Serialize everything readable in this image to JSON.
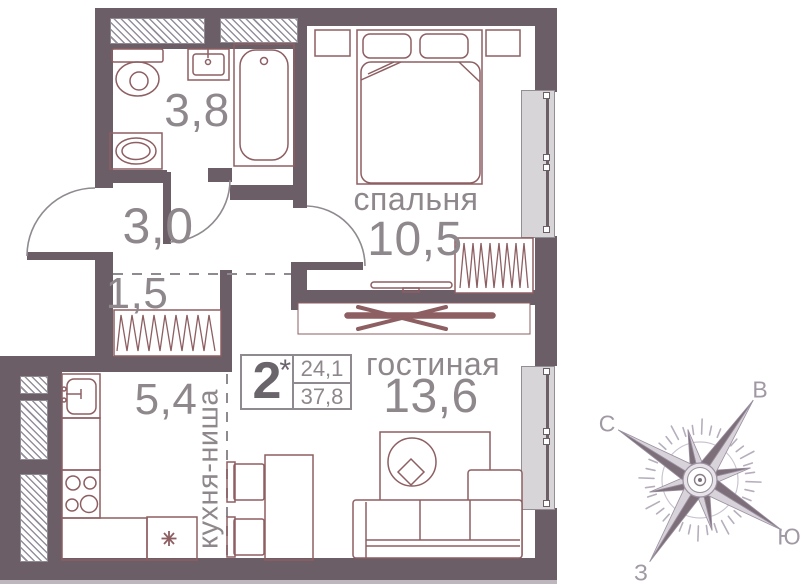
{
  "plan_type": "apartment-floor-plan",
  "rooms": {
    "bedroom": {
      "name": "спальня",
      "area": "10,5"
    },
    "living": {
      "name": "гостиная",
      "area": "13,6"
    },
    "kitchen": {
      "name": "кухня-ниша",
      "area": "5,4"
    },
    "bathroom": {
      "area": "3,8"
    },
    "hall": {
      "area": "3,0"
    },
    "closet": {
      "area": "1,5"
    }
  },
  "info": {
    "rooms_count": "2",
    "star": "*",
    "living_area": "24,1",
    "total_area": "37,8"
  },
  "compass": {
    "n": "С",
    "e": "В",
    "s": "Ю",
    "w": "З"
  },
  "colors": {
    "wall": "#6b5e66",
    "furniture_line": "#8d5f62",
    "label_text": "#8e888c",
    "info_number": "#6a646b",
    "window_glass": "#d8d5d8",
    "dash_line": "#8f8a90",
    "compass_dark": "#7d6f7a",
    "compass_light": "#d8d2da",
    "compass_text": "#a099a4"
  }
}
